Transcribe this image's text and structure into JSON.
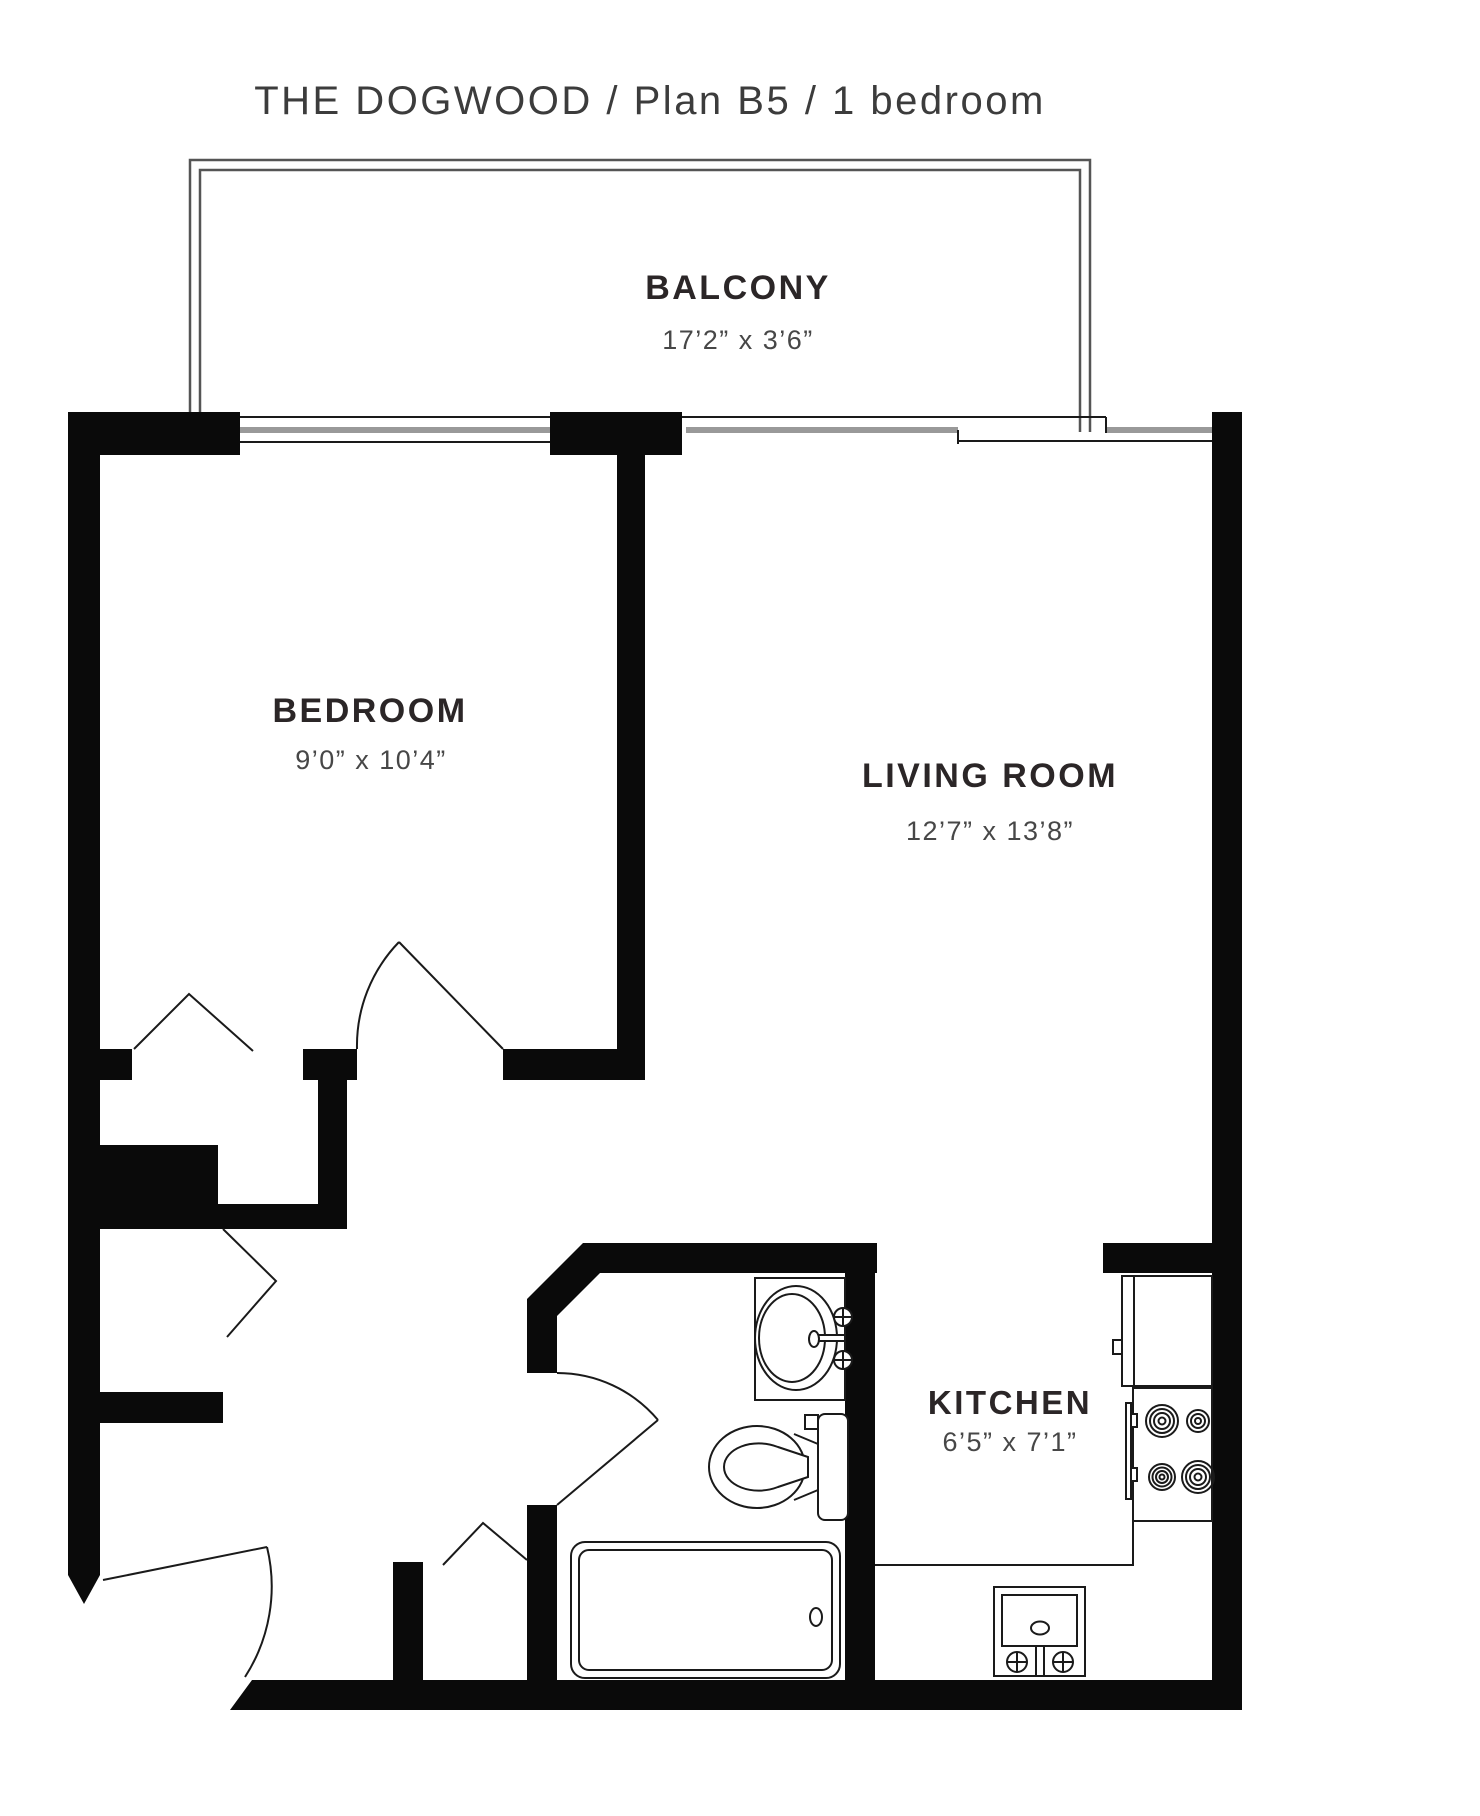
{
  "title": "THE DOGWOOD / Plan B5 / 1 bedroom",
  "rooms": {
    "balcony": {
      "name": "BALCONY",
      "dims": "17’2” x 3’6”"
    },
    "bedroom": {
      "name": "BEDROOM",
      "dims": "9’0” x 10’4”"
    },
    "living_room": {
      "name": "LIVING ROOM",
      "dims": "12’7” x 13’8”"
    },
    "kitchen": {
      "name": "KITCHEN",
      "dims": "6’5” x 7’1”"
    }
  },
  "colors": {
    "wall": "#0a0a0a",
    "line": "#1a1a1a",
    "glass": "#999999",
    "rail": "#555555",
    "label": "#2b2627",
    "dims": "#474747",
    "title": "#3c3c3c"
  }
}
